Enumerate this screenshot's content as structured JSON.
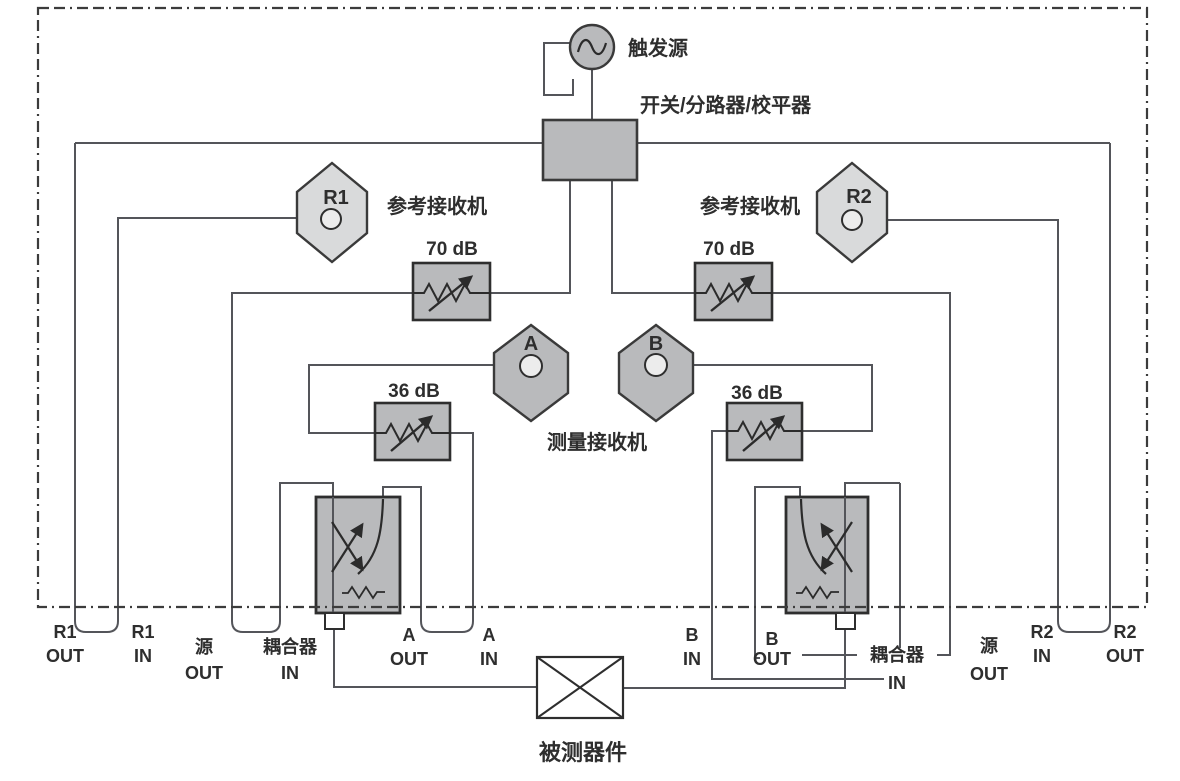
{
  "labels": {
    "trigger_source": "触发源",
    "switch_splitter_leveler": "开关/分路器/校平器",
    "ref_receiver_left": "参考接收机",
    "ref_receiver_right": "参考接收机",
    "meas_receiver": "测量接收机",
    "dut": "被测器件",
    "att70_left": "70 dB",
    "att70_right": "70 dB",
    "att36_left": "36 dB",
    "att36_right": "36 dB"
  },
  "receivers": {
    "r1": "R1",
    "r2": "R2",
    "a": "A",
    "b": "B"
  },
  "ports": {
    "r1_out": {
      "l1": "R1",
      "l2": "OUT"
    },
    "r1_in": {
      "l1": "R1",
      "l2": "IN"
    },
    "src_out_left": {
      "l1": "源",
      "l2": "OUT"
    },
    "cplr_in_left": {
      "l1": "耦合器",
      "l2": "IN"
    },
    "a_out": {
      "l1": "A",
      "l2": "OUT"
    },
    "a_in": {
      "l1": "A",
      "l2": "IN"
    },
    "b_in": {
      "l1": "B",
      "l2": "IN"
    },
    "b_out": {
      "l1": "B",
      "l2": "OUT"
    },
    "cplr_in_right": {
      "l1": "耦合器",
      "l2": "IN"
    },
    "src_out_right": {
      "l1": "源",
      "l2": "OUT"
    },
    "r2_in": {
      "l1": "R2",
      "l2": "IN"
    },
    "r2_out": {
      "l1": "R2",
      "l2": "OUT"
    }
  },
  "colors": {
    "box_fill": "#b9babc",
    "light_fill": "#d9dadb",
    "circle_fill": "#ececec",
    "wire": "#54555a",
    "outline": "#3a3a3a",
    "text": "#2e2e2e"
  }
}
